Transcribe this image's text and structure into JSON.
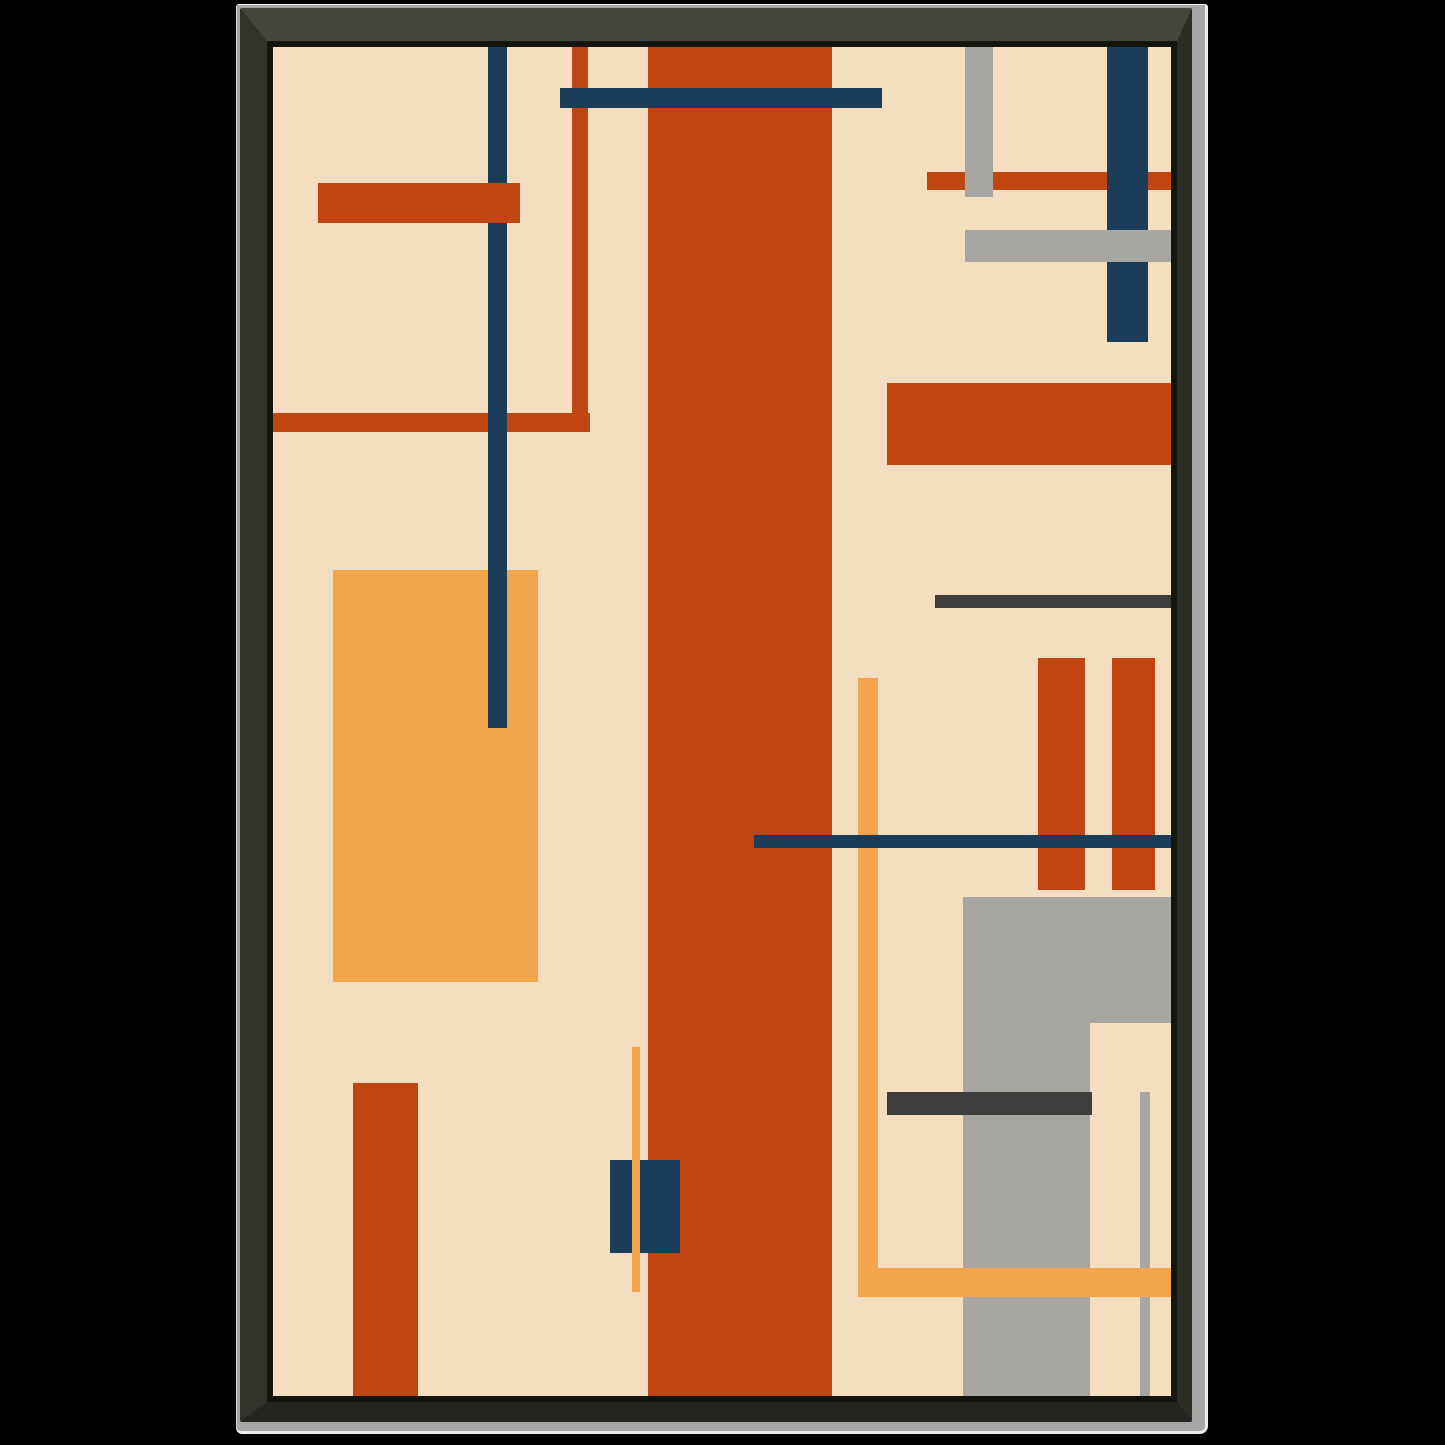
{
  "artwork": {
    "type": "abstract-geometric-composition",
    "canvas": {
      "width": 898,
      "height": 1349,
      "background": "cream"
    },
    "shapes": [
      {
        "name": "orange-l-horizontal-line",
        "x": 0,
        "y": 366,
        "w": 317,
        "h": 19,
        "color": "red",
        "z": 1
      },
      {
        "name": "orange-l-vertical-line",
        "x": 299,
        "y": 0,
        "w": 16,
        "h": 385,
        "color": "red",
        "z": 1
      },
      {
        "name": "amber-rectangle-left",
        "x": 60,
        "y": 523,
        "w": 205,
        "h": 412,
        "color": "amber",
        "z": 1
      },
      {
        "name": "navy-vline-left",
        "x": 215,
        "y": 0,
        "w": 19,
        "h": 681,
        "color": "navy",
        "z": 2
      },
      {
        "name": "orange-bar-topleft",
        "x": 45,
        "y": 136,
        "w": 202,
        "h": 40,
        "color": "red",
        "z": 3
      },
      {
        "name": "tall-red-column",
        "x": 375,
        "y": 0,
        "w": 184,
        "h": 1349,
        "color": "red",
        "z": 2
      },
      {
        "name": "navy-hbar-top",
        "x": 287,
        "y": 41,
        "w": 322,
        "h": 20,
        "color": "navy",
        "z": 3
      },
      {
        "name": "orange-line-topright",
        "x": 654,
        "y": 125,
        "w": 244,
        "h": 18,
        "color": "red",
        "z": 1
      },
      {
        "name": "gray-vbar-topright",
        "x": 692,
        "y": 0,
        "w": 28,
        "h": 150,
        "color": "gray",
        "z": 2
      },
      {
        "name": "navy-vbar-topright",
        "x": 834,
        "y": 0,
        "w": 41,
        "h": 295,
        "color": "navy",
        "z": 2
      },
      {
        "name": "gray-hbar-topright",
        "x": 692,
        "y": 183,
        "w": 206,
        "h": 32,
        "color": "gray",
        "z": 3
      },
      {
        "name": "red-rect-right",
        "x": 614,
        "y": 336,
        "w": 284,
        "h": 82,
        "color": "red",
        "z": 1
      },
      {
        "name": "charcoal-line-right",
        "x": 662,
        "y": 548,
        "w": 236,
        "h": 13,
        "color": "charcoal",
        "z": 1
      },
      {
        "name": "red-bar-right-a",
        "x": 765,
        "y": 611,
        "w": 47,
        "h": 232,
        "color": "red",
        "z": 2
      },
      {
        "name": "red-bar-right-b",
        "x": 839,
        "y": 611,
        "w": 43,
        "h": 232,
        "color": "red",
        "z": 2
      },
      {
        "name": "navy-hline-mid",
        "x": 481,
        "y": 788,
        "w": 417,
        "h": 13,
        "color": "navy",
        "z": 3
      },
      {
        "name": "amber-vline-right",
        "x": 585,
        "y": 631,
        "w": 20,
        "h": 619,
        "color": "amber",
        "z": 2
      },
      {
        "name": "amber-hline-bottom",
        "x": 585,
        "y": 1221,
        "w": 313,
        "h": 29,
        "color": "amber",
        "z": 4
      },
      {
        "name": "gray-block-wide",
        "x": 690,
        "y": 850,
        "w": 208,
        "h": 126,
        "color": "gray",
        "z": 2
      },
      {
        "name": "gray-block-column",
        "x": 690,
        "y": 850,
        "w": 127,
        "h": 499,
        "color": "gray",
        "z": 2
      },
      {
        "name": "charcoal-bar-bottom",
        "x": 614,
        "y": 1045,
        "w": 205,
        "h": 23,
        "color": "charcoal",
        "z": 3
      },
      {
        "name": "gray-thin-vline",
        "x": 867,
        "y": 1045,
        "w": 10,
        "h": 304,
        "color": "gray",
        "z": 3
      },
      {
        "name": "red-rect-bottomleft",
        "x": 80,
        "y": 1036,
        "w": 65,
        "h": 313,
        "color": "red",
        "z": 1
      },
      {
        "name": "navy-square-bottom",
        "x": 337,
        "y": 1113,
        "w": 70,
        "h": 93,
        "color": "navy",
        "z": 3
      },
      {
        "name": "amber-vline-center",
        "x": 359,
        "y": 1000,
        "w": 8,
        "h": 245,
        "color": "amber",
        "z": 4
      }
    ]
  },
  "palette": {
    "page_bg": "#000000",
    "cream": "#f3dfc0",
    "red": "#c04511",
    "navy": "#1c3d5a",
    "amber": "#f3a54d",
    "gray": "#a8a6a3",
    "charcoal": "#3d3d3b",
    "frame_top": "#45463c",
    "frame_left": "#31322a",
    "frame_right": "#2b2c25",
    "frame_bottom": "#242520",
    "frame_lip": "#15150f",
    "mat_silver": "#a6a6a6",
    "silver_highlight": "#ececec"
  }
}
